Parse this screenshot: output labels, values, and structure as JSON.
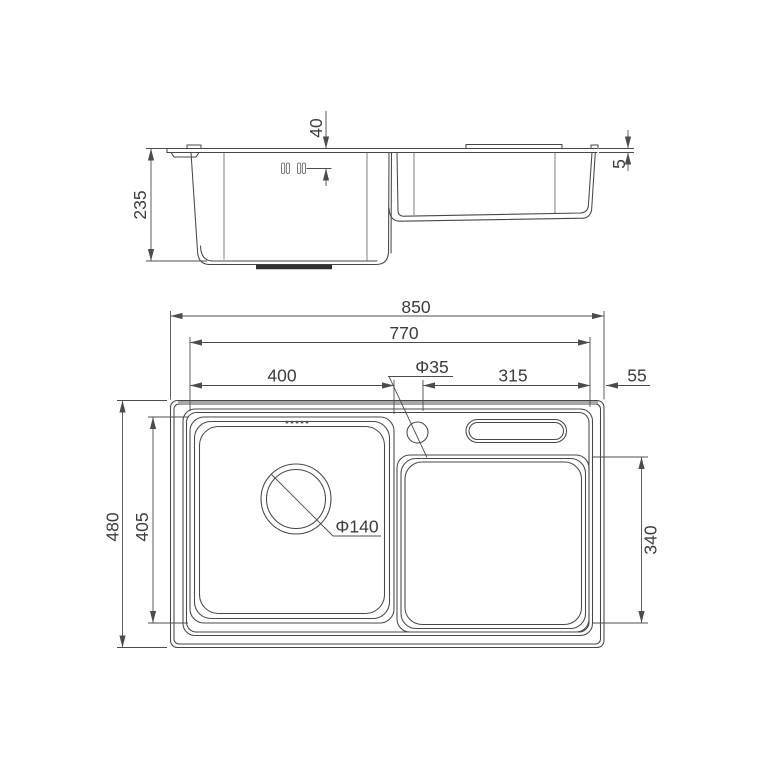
{
  "drawing": {
    "subject": "kitchen-sink-technical-drawing",
    "views": {
      "side_view_name": "side profile view",
      "plan_view_name": "top plan view"
    },
    "colors": {
      "background": "#ffffff",
      "line": "#474747",
      "dimension_line": "#4c4c4c",
      "text": "#3b3b3b",
      "shaded_edge": "#a8a8a8"
    },
    "dimensions": {
      "side": {
        "total_depth": "235",
        "overflow_from_rim": "40",
        "rim_height": "5"
      },
      "plan": {
        "overall_width": "850",
        "inner_width": "770",
        "bowl_width": "400",
        "faucet_hole_diameter": "Φ35",
        "drainboard_width": "315",
        "right_edge_width": "55",
        "overall_depth": "480",
        "bowl_outer_depth": "405",
        "drain_diameter": "Φ140",
        "drainboard_depth": "340"
      }
    }
  }
}
